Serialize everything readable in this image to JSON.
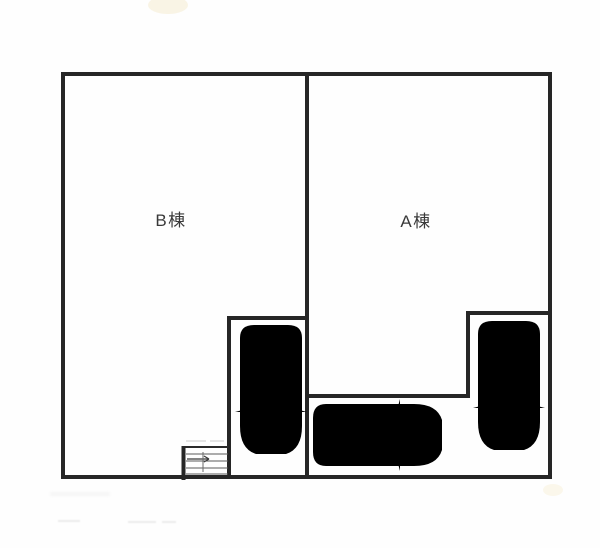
{
  "plan": {
    "type": "site-plan-floorplan",
    "labels": {
      "building_b": "B棟",
      "building_a": "A棟"
    },
    "colors": {
      "wall": "#262626",
      "car": "#6f6f6f",
      "label": "#3a3a3a",
      "bg": "#fefefe"
    },
    "icons": [
      "car-top-view-icon",
      "staircase-icon",
      "stair-direction-arrow-icon"
    ],
    "parking": {
      "car_count": 3
    }
  }
}
